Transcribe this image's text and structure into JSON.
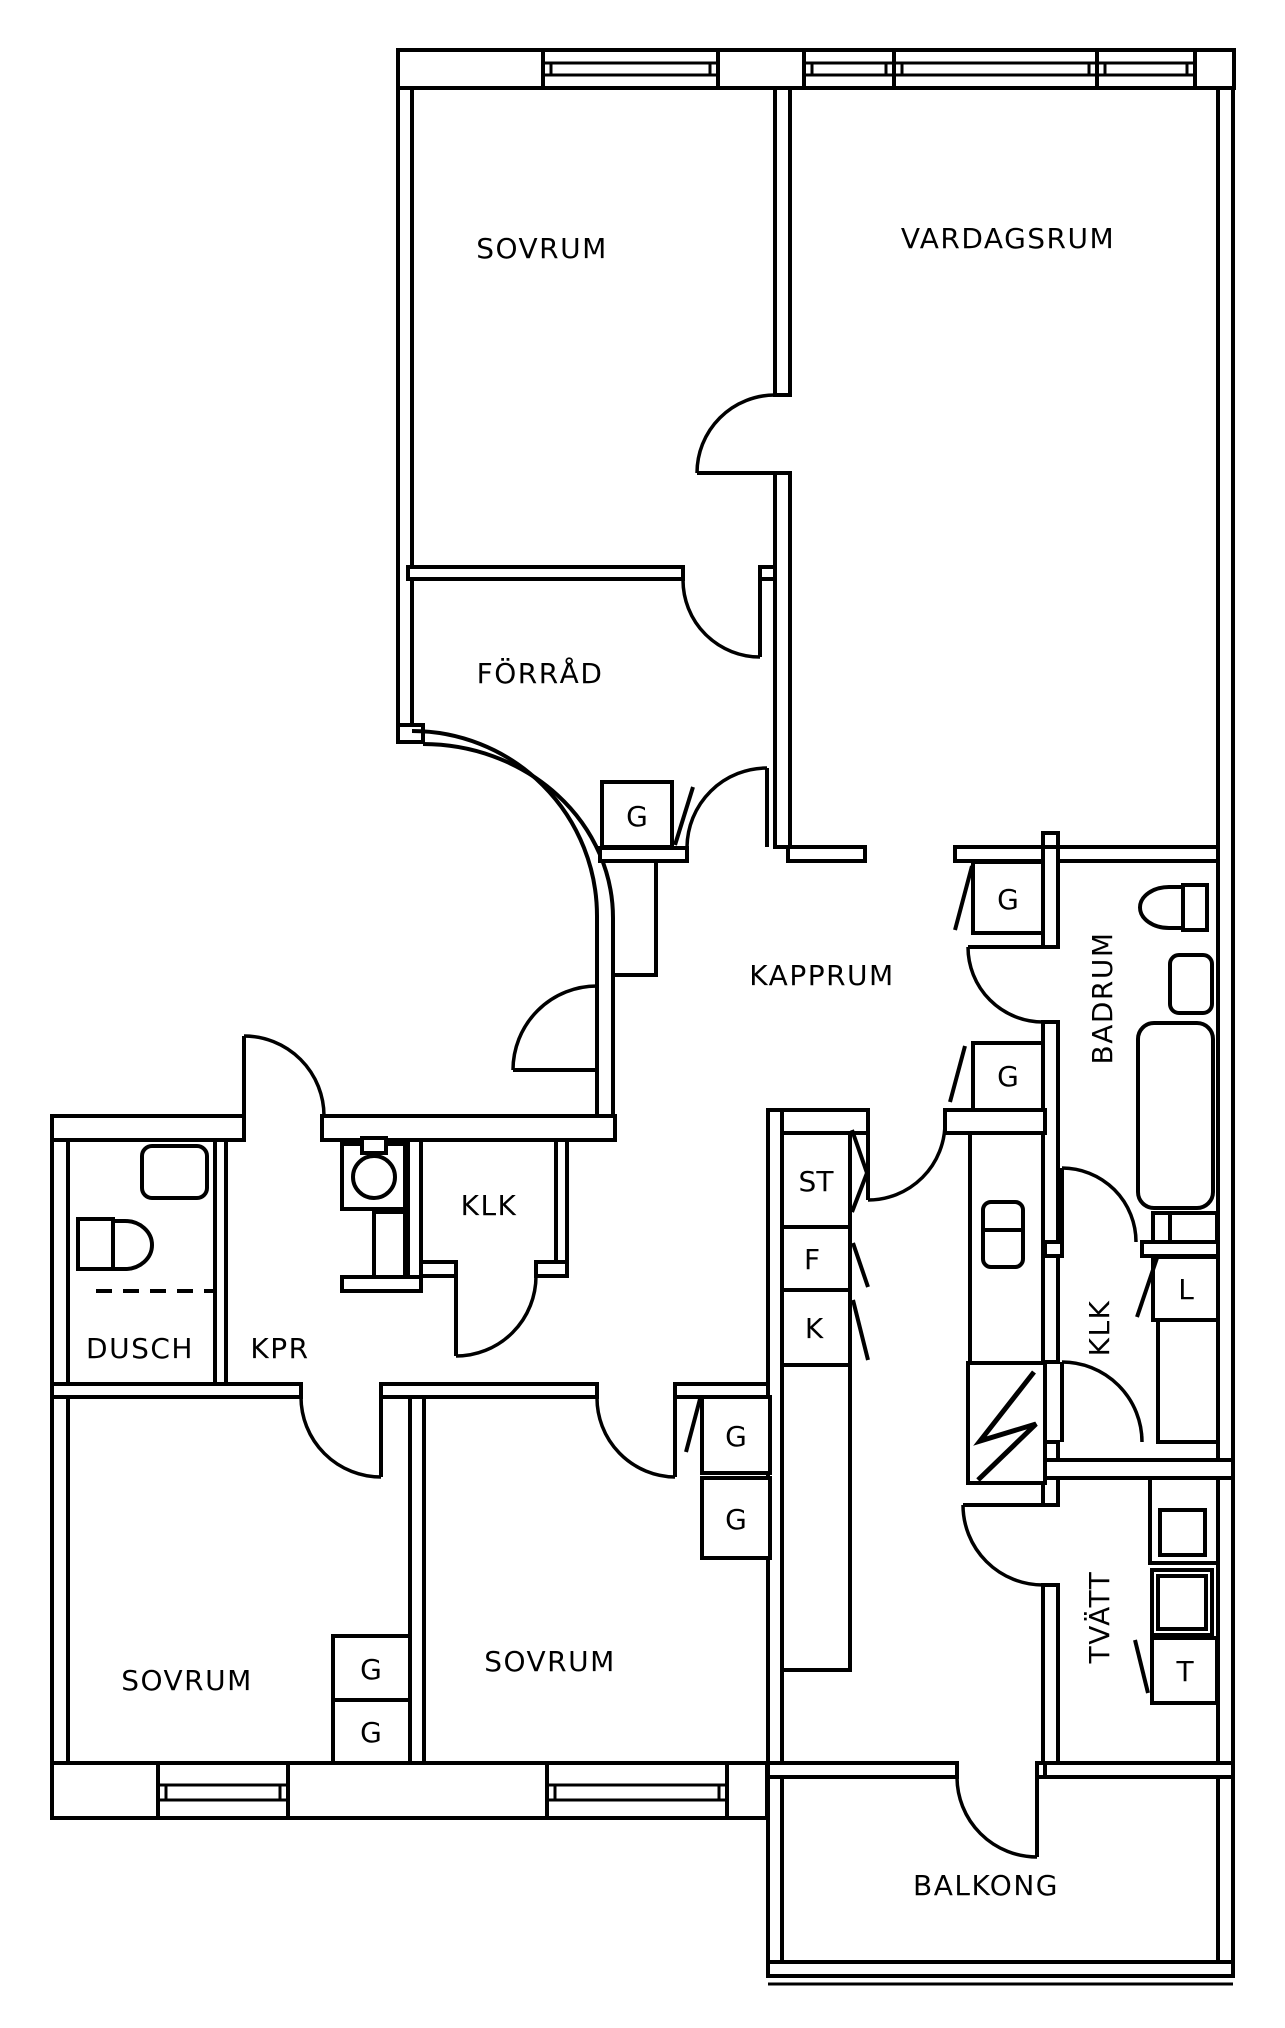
{
  "plan": {
    "title": "Apartment floor plan",
    "colors": {
      "line": "#000000",
      "background": "#ffffff"
    },
    "rooms": [
      {
        "id": "sovrum-top",
        "label": "SOVRUM"
      },
      {
        "id": "vardagsrum",
        "label": "VARDAGSRUM"
      },
      {
        "id": "forrad",
        "label": "FÖRRÅD"
      },
      {
        "id": "kapprum",
        "label": "KAPPRUM"
      },
      {
        "id": "badrum",
        "label": "BADRUM"
      },
      {
        "id": "dusch",
        "label": "DUSCH"
      },
      {
        "id": "kpr",
        "label": "KPR"
      },
      {
        "id": "klk-inner",
        "label": "KLK"
      },
      {
        "id": "klk-right",
        "label": "KLK"
      },
      {
        "id": "tvatt",
        "label": "TVÄTT"
      },
      {
        "id": "sovrum-left",
        "label": "SOVRUM"
      },
      {
        "id": "sovrum-mid",
        "label": "SOVRUM"
      },
      {
        "id": "balkong",
        "label": "BALKONG"
      }
    ],
    "closets": [
      {
        "id": "g-forrad",
        "label": "G"
      },
      {
        "id": "g-hall-upper",
        "label": "G"
      },
      {
        "id": "g-hall-lower",
        "label": "G"
      },
      {
        "id": "g-sovrum-left-1",
        "label": "G"
      },
      {
        "id": "g-sovrum-left-2",
        "label": "G"
      },
      {
        "id": "g-sovrum-mid-1",
        "label": "G"
      },
      {
        "id": "g-sovrum-mid-2",
        "label": "G"
      },
      {
        "id": "st-closet",
        "label": "ST"
      },
      {
        "id": "f-closet",
        "label": "F"
      },
      {
        "id": "k-closet",
        "label": "K"
      },
      {
        "id": "l-closet",
        "label": "L"
      },
      {
        "id": "t-closet",
        "label": "T"
      }
    ]
  }
}
